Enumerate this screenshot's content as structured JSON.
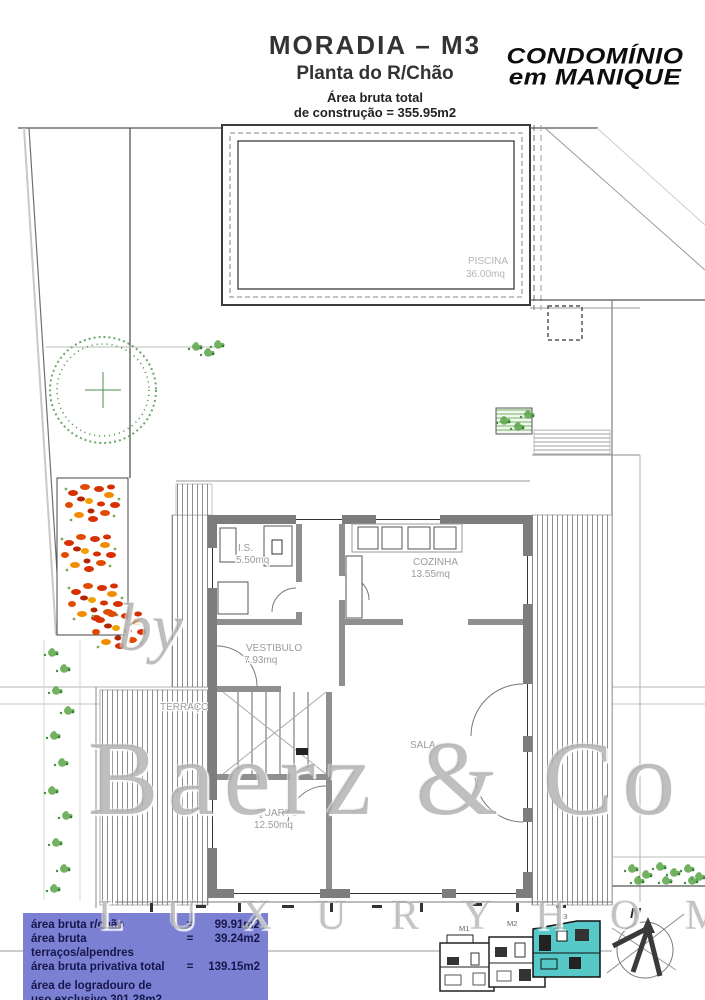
{
  "header": {
    "title": "MORADIA – M3",
    "subtitle": "Planta do R/Chão",
    "area_note_line1": "Área bruta total",
    "area_note_line2": "de construção = 355.95m2"
  },
  "logo": {
    "line1": "CONDOMÍNIO",
    "line2": "em MANIQUE"
  },
  "watermark": {
    "prefix": "by",
    "name": "Baerz & Co",
    "tagline": "L U X U R Y   H O M E S"
  },
  "plan_labels": {
    "piscina": {
      "name": "PISCINA",
      "area": "36.00mq"
    },
    "is": {
      "name": "I.S.",
      "area": "5.50mq"
    },
    "cozinha": {
      "name": "COZINHA",
      "area": "13.55mq"
    },
    "vestibulo": {
      "name": "VESTIBULO",
      "area": "7.93mq"
    },
    "sala": {
      "name": "SALA",
      "area": ""
    },
    "quarto": {
      "name": "QUARTO",
      "area": "12.50mq"
    },
    "terraco": {
      "name": "TERRAÇO",
      "area": ""
    }
  },
  "areas_box": {
    "bg": "#7b80d3",
    "rows": [
      {
        "label": "área bruta r/chão",
        "eq": "=",
        "value": "99.91m2"
      },
      {
        "label": "área bruta terraços/alpendres",
        "eq": "=",
        "value": "39.24m2"
      },
      {
        "label": "área bruta privativa total",
        "eq": "=",
        "value": "139.15m2"
      }
    ],
    "footer_line1": "área de logradouro de",
    "footer_line2": "uso exclusivo 301.28m2"
  },
  "minimap": {
    "units": [
      {
        "label": "M1"
      },
      {
        "label": "M2"
      },
      {
        "label": "M3"
      }
    ],
    "highlight_color": "#56c8c8"
  },
  "compass": {
    "north_label": "N"
  },
  "colors": {
    "wall_gray": "#7d7d7d",
    "highlight_cyan": "#56c8c8",
    "flower_red": "#d63000",
    "flower_orange": "#f08c00",
    "tree_green": "#3f8f3f",
    "areas_box_bg": "#7b80d3"
  }
}
